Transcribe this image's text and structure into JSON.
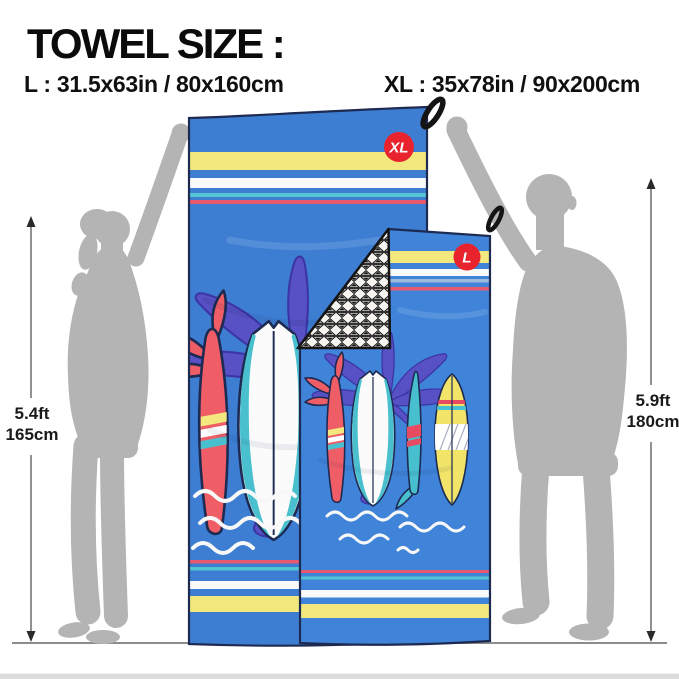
{
  "title": "TOWEL SIZE :",
  "sizes": {
    "l": "L : 31.5x63in / 80x160cm",
    "xl": "XL : 35x78in / 90x200cm"
  },
  "towels": {
    "xl_badge": "XL",
    "l_badge": "L"
  },
  "measurements": {
    "left": {
      "feet": "5.4ft",
      "cm": "165cm"
    },
    "right": {
      "feet": "5.9ft",
      "cm": "180cm"
    }
  },
  "colors": {
    "towel_blue": "#3d7ed3",
    "stripe_yellow": "#f2e87d",
    "stripe_white": "#fafafa",
    "stripe_cyan": "#54c4d3",
    "stripe_pink": "#e8586e",
    "badge_red": "#e8232d",
    "palm_purple": "#5751c5",
    "board_red": "#ef5d66",
    "board_teal": "#47bfce",
    "board_yellow": "#f1e468",
    "outline_navy": "#1d2a52",
    "silhouette_gray": "#b4b4b4",
    "floor_gray": "#8c8c8c"
  }
}
